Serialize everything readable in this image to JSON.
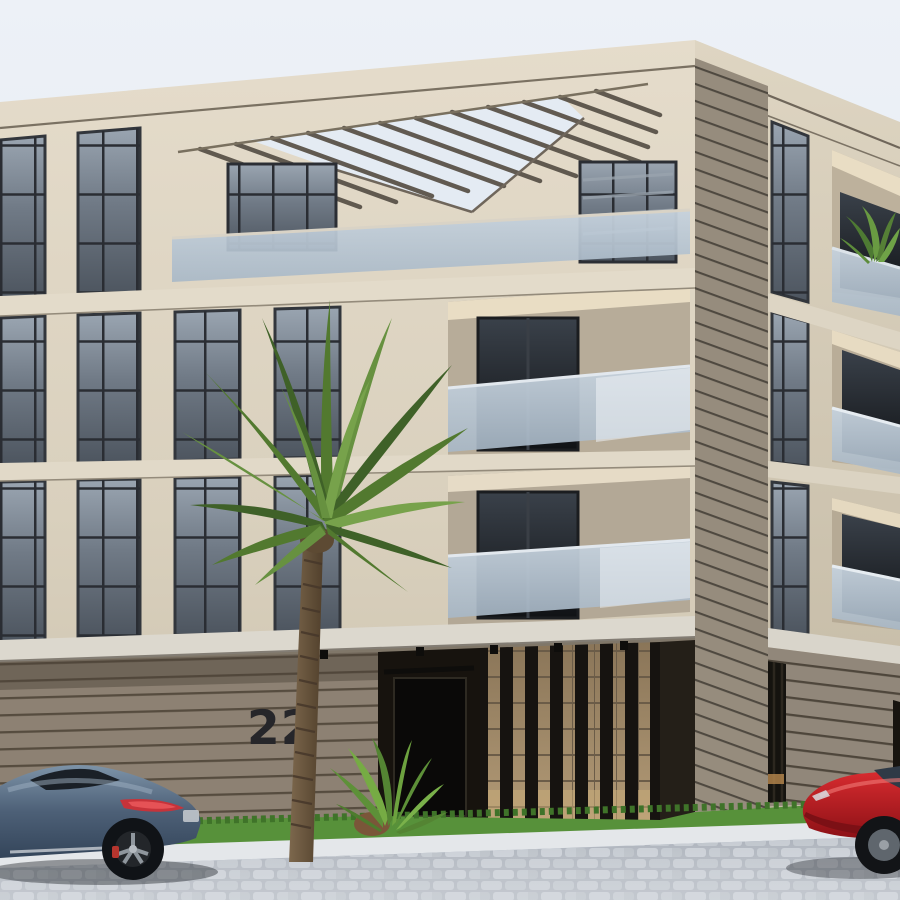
{
  "scene": {
    "type": "architectural-exterior-render",
    "description": "Modern four-storey beige stone apartment building on a street corner with a rooftop pergola, recessed frosted-glass balconies, floor-to-ceiling gridded windows, wood-slat ground floor, a tall palm tree, grass verge and cobblestone street; a steel-blue sports coupe is parked at left and a red sedan enters at right.",
    "building": {
      "number": "22",
      "storeys": 4,
      "features": [
        "rooftop pergola slats",
        "frosted glass balcony rails",
        "gridded floor-to-ceiling windows",
        "horizontal slat ground-floor cladding",
        "vertical slat entrance screen",
        "corner slat cladding strip",
        "recessed dark entrance door"
      ]
    },
    "vegetation": [
      "tall palm tree",
      "small palm shrub",
      "balcony plant",
      "grass verge"
    ],
    "vehicles": [
      {
        "type": "sports coupe",
        "color_name": "steel blue",
        "hex": "#4d6077"
      },
      {
        "type": "sedan",
        "color_name": "red",
        "hex": "#c4201f"
      }
    ],
    "street_elements": [
      "cobblestone pavement",
      "white curb",
      "grass strip"
    ],
    "sky": "pale overcast blue",
    "colors": {
      "sky_top": "#edf1f7",
      "sky_bottom": "#dde5f0",
      "stone_light": "#e3dbca",
      "stone_mid": "#d6cdbb",
      "stone_shadow": "#c2b8a4",
      "slat_wood": "#8d8173",
      "glass_dark": "#3c434d",
      "glass_sky": "#93a0ad",
      "frosted_glass": "#b9c7d5",
      "grass": "#57913a",
      "pavement": "#adb3bc",
      "curb": "#e4e7ea",
      "car_blue": "#4d6077",
      "car_red": "#c4201f",
      "palm_green_dark": "#3f6128",
      "palm_green_light": "#77a24b",
      "door_black": "#0b0a08",
      "number_color": "#26262a"
    }
  }
}
